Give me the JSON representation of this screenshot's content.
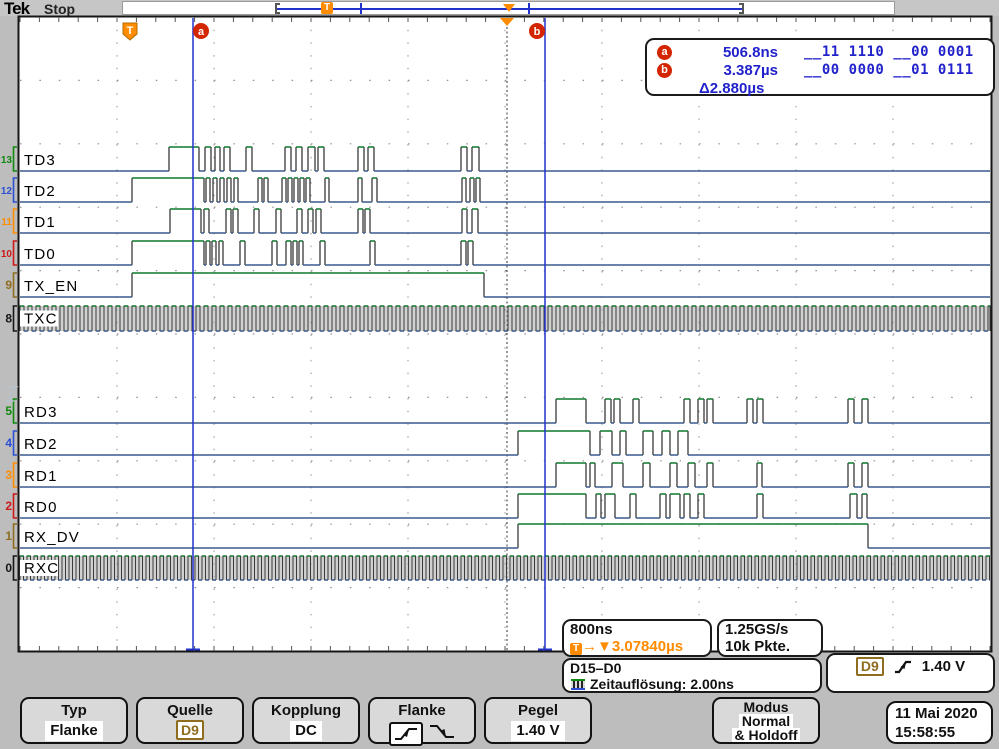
{
  "header": {
    "logo": "Tek",
    "status": "Stop"
  },
  "cursor_readout": {
    "a_label": "a",
    "a_time": "506.8ns",
    "a_bits": "__11 1110 __00 0001",
    "b_label": "b",
    "b_time": "3.387µs",
    "b_bits": "__00 0000 __01 0111",
    "delta": "Δ2.880µs"
  },
  "boxes": {
    "timebase": "800ns",
    "delay_t": "T",
    "delay_arrow": "→",
    "delay_marker": "▼",
    "delay_value": "3.07840µs",
    "samplerate": "1.25GS/s",
    "record_len": "10k Pkte.",
    "bus_label": "D15–D0",
    "bus_info": "Zeitauflösung: 2.00ns",
    "trig_source": "D9",
    "trig_level": "1.40 V"
  },
  "menu": {
    "typ": {
      "title": "Typ",
      "value": "Flanke"
    },
    "quelle": {
      "title": "Quelle",
      "value": "D9"
    },
    "kopplung": {
      "title": "Kopplung",
      "value": "DC"
    },
    "flanke": {
      "title": "Flanke"
    },
    "pegel": {
      "title": "Pegel",
      "value": "1.40 V"
    },
    "modus": {
      "title": "Modus",
      "line1": "Normal",
      "line2": "& Holdoff"
    }
  },
  "datetime": {
    "date": "11 Mai  2020",
    "time": "15:58:55"
  },
  "waveforms": {
    "colors": {
      "high": "#0f7a2f",
      "low": "#3a5a8c",
      "edge": "#2a2a2a",
      "grid": "#909090",
      "tick": "#555555",
      "cursor": "#2233cc",
      "trigger": "#ff8c00",
      "marker_circle": "#d32500"
    },
    "area": {
      "x0": 20,
      "x1": 990,
      "y0": 17,
      "y1": 651,
      "div_x": 97,
      "div_y": 63.4
    },
    "cursors": {
      "a_x": 193,
      "b_x": 545,
      "a_bubble_x": 201,
      "b_bubble_x": 537,
      "bubble_y": 31
    },
    "trigger": {
      "line_x": 507,
      "flag_x": 130,
      "flag_y": 31,
      "flag_label": "T",
      "expand_x": 507
    },
    "channels": [
      {
        "num": "13",
        "label": "TD3",
        "color": "#0f8a0f",
        "type": "data",
        "base": 171,
        "high": 147,
        "segs": [
          [
            169,
            199
          ],
          [
            205,
            211
          ],
          [
            215,
            220
          ],
          [
            224,
            230
          ],
          [
            246,
            252
          ],
          [
            285,
            291
          ],
          [
            296,
            302
          ],
          [
            308,
            315
          ],
          [
            318,
            324
          ],
          [
            358,
            364
          ],
          [
            368,
            374
          ],
          [
            461,
            467
          ],
          [
            472,
            479
          ]
        ]
      },
      {
        "num": "12",
        "label": "TD2",
        "color": "#2b50d4",
        "type": "data",
        "base": 202,
        "high": 178,
        "segs": [
          [
            132,
            204
          ],
          [
            206,
            210
          ],
          [
            213,
            217
          ],
          [
            220,
            224
          ],
          [
            227,
            231
          ],
          [
            234,
            238
          ],
          [
            258,
            262
          ],
          [
            264,
            268
          ],
          [
            282,
            286
          ],
          [
            288,
            292
          ],
          [
            294,
            298
          ],
          [
            300,
            304
          ],
          [
            306,
            310
          ],
          [
            325,
            329
          ],
          [
            358,
            362
          ],
          [
            372,
            377
          ],
          [
            462,
            466
          ],
          [
            470,
            474
          ],
          [
            476,
            480
          ]
        ]
      },
      {
        "num": "11",
        "label": "TD1",
        "color": "#ff8c00",
        "type": "data",
        "base": 233,
        "high": 209,
        "segs": [
          [
            170,
            201
          ],
          [
            204,
            209
          ],
          [
            226,
            231
          ],
          [
            233,
            238
          ],
          [
            254,
            259
          ],
          [
            276,
            281
          ],
          [
            297,
            302
          ],
          [
            308,
            313
          ],
          [
            316,
            321
          ],
          [
            358,
            363
          ],
          [
            365,
            370
          ],
          [
            462,
            467
          ],
          [
            472,
            478
          ]
        ]
      },
      {
        "num": "10",
        "label": "TD0",
        "color": "#cc1818",
        "type": "data",
        "base": 265,
        "high": 241,
        "segs": [
          [
            132,
            204
          ],
          [
            206,
            210
          ],
          [
            212,
            216
          ],
          [
            219,
            223
          ],
          [
            240,
            245
          ],
          [
            272,
            277
          ],
          [
            286,
            291
          ],
          [
            293,
            297
          ],
          [
            299,
            303
          ],
          [
            320,
            325
          ],
          [
            370,
            375
          ],
          [
            461,
            466
          ],
          [
            468,
            473
          ]
        ]
      },
      {
        "num": "9",
        "label": "TX_EN",
        "color": "#8f6d1f",
        "type": "data",
        "base": 297,
        "high": 273,
        "segs": [
          [
            132,
            484
          ]
        ]
      },
      {
        "num": "8",
        "label": "TXC",
        "color": "#161616",
        "type": "clock",
        "top": 306,
        "bottom": 331,
        "period": 8
      },
      {
        "num": "5",
        "label": "RD3",
        "color": "#0f8a0f",
        "type": "data",
        "base": 423,
        "high": 399,
        "segs": [
          [
            556,
            586
          ],
          [
            605,
            611
          ],
          [
            614,
            620
          ],
          [
            633,
            639
          ],
          [
            684,
            690
          ],
          [
            698,
            704
          ],
          [
            707,
            713
          ],
          [
            747,
            753
          ],
          [
            757,
            763
          ],
          [
            848,
            854
          ],
          [
            862,
            868
          ]
        ]
      },
      {
        "num": "4",
        "label": "RD2",
        "color": "#2b50d4",
        "type": "data",
        "base": 455,
        "high": 431,
        "segs": [
          [
            518,
            590
          ],
          [
            600,
            612
          ],
          [
            620,
            626
          ],
          [
            643,
            653
          ],
          [
            662,
            670
          ],
          [
            678,
            688
          ]
        ]
      },
      {
        "num": "3",
        "label": "RD1",
        "color": "#ff8c00",
        "type": "data",
        "base": 487,
        "high": 463,
        "segs": [
          [
            556,
            586
          ],
          [
            590,
            595
          ],
          [
            612,
            623
          ],
          [
            643,
            650
          ],
          [
            670,
            677
          ],
          [
            688,
            695
          ],
          [
            707,
            713
          ],
          [
            757,
            762
          ],
          [
            848,
            854
          ],
          [
            862,
            868
          ]
        ]
      },
      {
        "num": "2",
        "label": "RD0",
        "color": "#cc1818",
        "type": "data",
        "base": 518,
        "high": 494,
        "segs": [
          [
            518,
            586
          ],
          [
            596,
            601
          ],
          [
            605,
            615
          ],
          [
            630,
            636
          ],
          [
            660,
            666
          ],
          [
            670,
            680
          ],
          [
            684,
            690
          ],
          [
            698,
            704
          ],
          [
            757,
            763
          ],
          [
            850,
            857
          ],
          [
            862,
            867
          ]
        ]
      },
      {
        "num": "1",
        "label": "RX_DV",
        "color": "#8f6d1f",
        "type": "data",
        "base": 548,
        "high": 524,
        "segs": [
          [
            518,
            868
          ]
        ]
      },
      {
        "num": "0",
        "label": "RXC",
        "color": "#161616",
        "type": "clock",
        "top": 556,
        "bottom": 580,
        "period": 7
      }
    ]
  }
}
